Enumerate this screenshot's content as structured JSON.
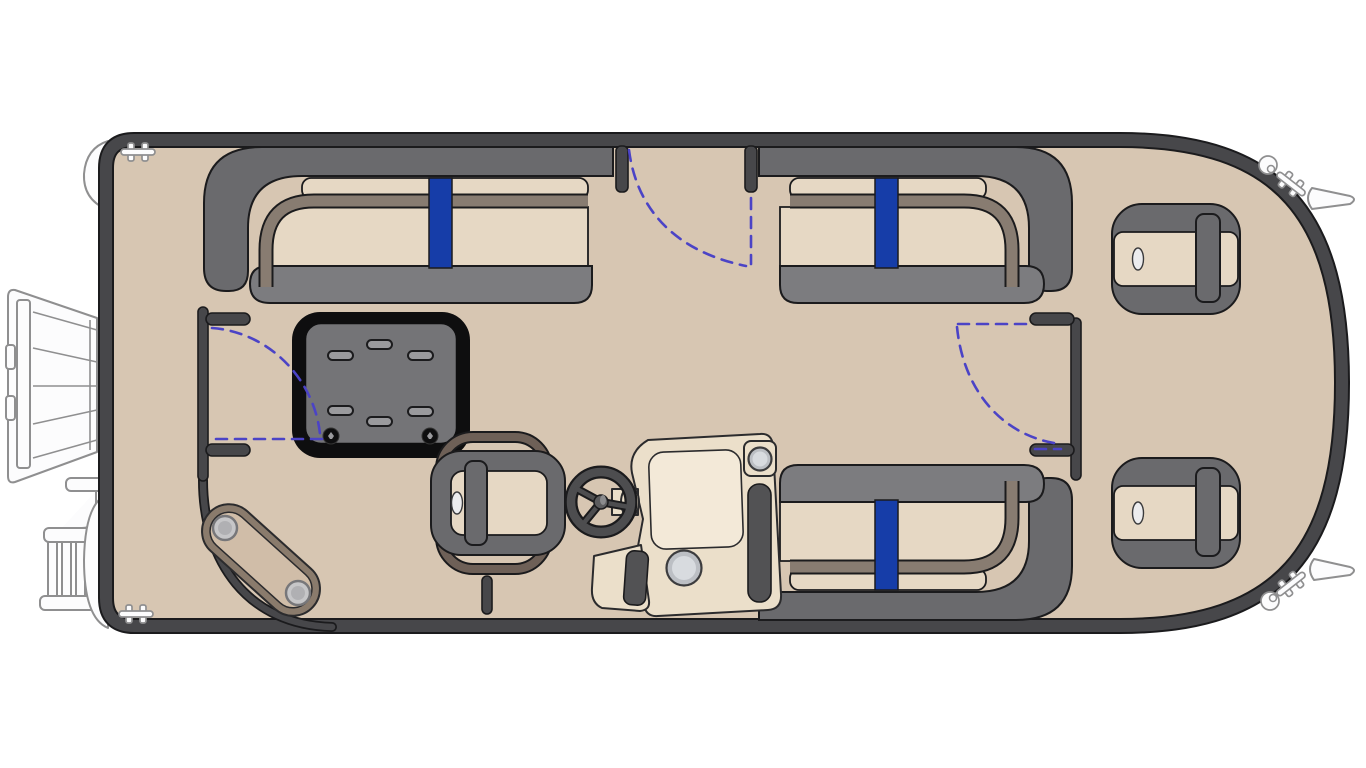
{
  "page": {
    "background": "#ffffff",
    "description": "Top-down floor plan diagram of a pontoon boat with rounded bow on the right, outboard motor and boarding ladder on the left"
  },
  "colors": {
    "pageBg": "#ffffff",
    "deck": "#d7c6b2",
    "hull": "#47474a",
    "line": "#1b1b1d",
    "backrest": "#6a6a6d",
    "base": "#7c7c7f",
    "cushion": "#e6d8c4",
    "trim": "#887c71",
    "trim2": "#6e6057",
    "accent": "#163da8",
    "swing": "#4b43c6",
    "tableFrame": "#0e0e0f",
    "tableTop": "#747477",
    "slot": "#9a9a9d",
    "console": "#ebdfca",
    "panel": "#f3e9d8",
    "darkPad": "#525254",
    "metal": "#bcbfc4",
    "metalInner": "#d8dbdf",
    "ghost": "#8f8f90",
    "ghostFill": "#fcfcfd",
    "bean": "#8a7b6c",
    "beanInner": "#d0bda8",
    "disc": "#c6c6c8",
    "discRing": "#77777a"
  },
  "components": [
    {
      "name": "outboard-motor",
      "location": "left exterior (stern)"
    },
    {
      "name": "boarding-ladder",
      "location": "lower-left exterior"
    },
    {
      "name": "pontoon-tube-tips",
      "count": 2,
      "location": "left exterior"
    },
    {
      "name": "bow-fins",
      "count": 2,
      "location": "right exterior"
    },
    {
      "name": "dock-cleat",
      "count": 4,
      "locations": [
        "top-left",
        "bottom-left",
        "top-right",
        "bottom-right"
      ]
    },
    {
      "name": "nav-light",
      "count": 2,
      "locations": [
        "top-right",
        "bottom-right"
      ]
    },
    {
      "name": "lounge-top-left",
      "type": "L-lounge bench",
      "stripe": "blue"
    },
    {
      "name": "lounge-top-right",
      "type": "L-lounge bench",
      "stripe": "blue"
    },
    {
      "name": "lounge-bottom-right",
      "type": "L-lounge bench",
      "stripe": "blue"
    },
    {
      "name": "table",
      "cup_slots": 6,
      "pedestal_fittings": 2
    },
    {
      "name": "captain-chair",
      "facing": "right"
    },
    {
      "name": "helm-console",
      "features": [
        "steering-wheel",
        "square-cup-holder",
        "round-cup-holder",
        "footwell",
        "dash-panel"
      ]
    },
    {
      "name": "bow-chair-upper",
      "facing": "left"
    },
    {
      "name": "bow-chair-lower",
      "facing": "left"
    },
    {
      "name": "corner-step-pad",
      "discs": 2,
      "location": "bottom-left deck corner"
    },
    {
      "name": "gate-top-center",
      "indicator": "dashed swing arc"
    },
    {
      "name": "gate-left-side",
      "indicator": "dashed swing arc"
    },
    {
      "name": "gate-right-side",
      "indicator": "dashed swing arc"
    },
    {
      "name": "tow-post",
      "location": "bottom center"
    }
  ]
}
